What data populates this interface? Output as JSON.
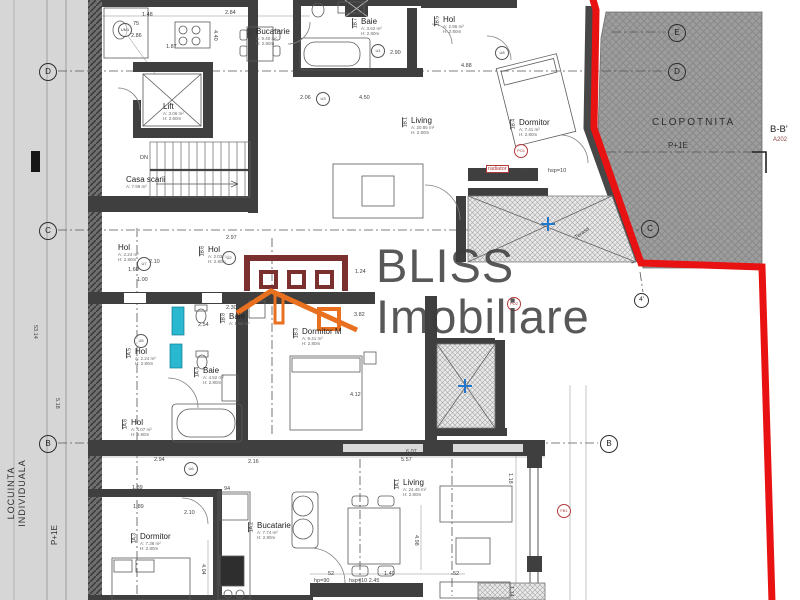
{
  "watermark": {
    "line1": "BLISS",
    "line2": "Imobiliare"
  },
  "logo_colors": {
    "building": "#7b3030",
    "roof": "#e8701f"
  },
  "accents": {
    "property_line": "#e81212",
    "fixture_teal": "#29b8cf",
    "drain_blue": "#2277cc"
  },
  "left_band": {
    "zone_line1": "LOCUINTA",
    "zone_line2": "INDIVIDUALA",
    "level": "P+1E"
  },
  "clopotnita": {
    "label": "CLOPOTNITA",
    "level": "P+1E"
  },
  "section_mark": {
    "label": "B-B'",
    "sheet": "A202"
  },
  "plan": {
    "rooms": [
      {
        "id": "1B.2",
        "name": "Bucatarie",
        "area": "A: 9.40 m²",
        "h": "H: 2.80m",
        "x": 247,
        "y": 28
      },
      {
        "id": "",
        "name": "Lift",
        "area": "A: 3.06 m²",
        "h": "H: 2.60m",
        "x": 163,
        "y": 103
      },
      {
        "id": "",
        "name": "Casa scarii",
        "area": "A: 7.99 m²",
        "h": "",
        "x": 126,
        "y": 176
      },
      {
        "id": "1B.7",
        "name": "Baie",
        "area": "A: 3.62 m²",
        "h": "H: 2.80m",
        "x": 352,
        "y": 18
      },
      {
        "id": "1B.5",
        "name": "Hol",
        "area": "A: 2.96 m²",
        "h": "H: 2.80m",
        "x": 434,
        "y": 16
      },
      {
        "id": "1B.1",
        "name": "Living",
        "area": "A: 20.85 m²",
        "h": "H: 2.80m",
        "x": 402,
        "y": 117
      },
      {
        "id": "1B.4",
        "name": "Dormitor",
        "area": "A: 7.41 m²",
        "h": "H: 2.80m",
        "x": 510,
        "y": 119
      },
      {
        "id": "1B.6",
        "name": "Hol",
        "area": "A: 2.03 m²",
        "h": "H: 2.80m",
        "x": 199,
        "y": 246
      },
      {
        "id": "",
        "name": "Hol",
        "area": "A: 2.24 m²",
        "h": "H: 2.80m",
        "x": 118,
        "y": 244
      },
      {
        "id": "1B.8",
        "name": "Baie",
        "area": "A: 1.92 m²",
        "h": "",
        "x": 220,
        "y": 313
      },
      {
        "id": "1B.3",
        "name": "Dormitor M",
        "area": "A: 9.41 m²",
        "h": "H: 2.80m",
        "x": 293,
        "y": 328
      },
      {
        "id": "1A.5",
        "name": "Hol",
        "area": "A: 2.24 m²",
        "h": "H: 2.80m",
        "x": 126,
        "y": 348
      },
      {
        "id": "1A.4",
        "name": "Baie",
        "area": "A: 4.52 m²",
        "h": "H: 2.80m",
        "x": 194,
        "y": 367
      },
      {
        "id": "1A.6",
        "name": "Hol",
        "area": "A: 4.07 m²",
        "h": "H: 2.80m",
        "x": 122,
        "y": 419
      },
      {
        "id": "1A.3",
        "name": "Dormitor",
        "area": "A: 7.38 m²",
        "h": "H: 2.80m",
        "x": 131,
        "y": 533
      },
      {
        "id": "1A.2",
        "name": "Bucatarie",
        "area": "A: 7.74 m²",
        "h": "H: 2.80m",
        "x": 248,
        "y": 522
      },
      {
        "id": "1A.1",
        "name": "Living",
        "area": "A: 24.45 m²",
        "h": "H: 2.80m",
        "x": 394,
        "y": 479
      }
    ],
    "grid_markers": [
      {
        "label": "D",
        "x": 47,
        "y": 71
      },
      {
        "label": "C",
        "x": 47,
        "y": 230
      },
      {
        "label": "B",
        "x": 47,
        "y": 443
      },
      {
        "label": "E",
        "x": 676,
        "y": 32
      },
      {
        "label": "D",
        "x": 676,
        "y": 71
      },
      {
        "label": "C",
        "x": 649,
        "y": 228
      },
      {
        "label": "B",
        "x": 608,
        "y": 443
      },
      {
        "label": "4'",
        "x": 642,
        "y": 301,
        "small": true
      }
    ],
    "circle_markers": [
      {
        "t": "UM1",
        "x": 124,
        "y": 29
      },
      {
        "t": "U1",
        "x": 377,
        "y": 50
      },
      {
        "t": "U8",
        "x": 501,
        "y": 52
      },
      {
        "t": "U3",
        "x": 322,
        "y": 98
      },
      {
        "t": "U2",
        "x": 228,
        "y": 257
      },
      {
        "t": "U7",
        "x": 143,
        "y": 263
      },
      {
        "t": "U5",
        "x": 140,
        "y": 340
      },
      {
        "t": "U6",
        "x": 190,
        "y": 468
      },
      {
        "t": "PO1",
        "x": 520,
        "y": 150,
        "red": true
      },
      {
        "t": "PO2",
        "x": 513,
        "y": 303,
        "red": true
      },
      {
        "t": "FB1",
        "x": 563,
        "y": 510,
        "red": true
      }
    ],
    "annotations": [
      {
        "t": "1.48",
        "x": 142,
        "y": 12
      },
      {
        "t": "2.84",
        "x": 225,
        "y": 10
      },
      {
        "t": "1.87",
        "x": 166,
        "y": 44
      },
      {
        "t": "4.40",
        "x": 218,
        "y": 30,
        "r": 90
      },
      {
        "t": "2.06",
        "x": 300,
        "y": 95
      },
      {
        "t": "75",
        "x": 133,
        "y": 21
      },
      {
        "t": "2.86",
        "x": 131,
        "y": 33
      },
      {
        "t": "2.90",
        "x": 390,
        "y": 50
      },
      {
        "t": "3.60",
        "x": 361,
        "y": 72
      },
      {
        "t": "4.50",
        "x": 359,
        "y": 95
      },
      {
        "t": "4.88",
        "x": 461,
        "y": 63
      },
      {
        "t": "DN",
        "x": 140,
        "y": 155
      },
      {
        "t": "+3.60",
        "x": 126,
        "y": 201
      },
      {
        "t": "2.97",
        "x": 226,
        "y": 235
      },
      {
        "t": "2.10",
        "x": 149,
        "y": 259
      },
      {
        "t": "1.60",
        "x": 128,
        "y": 267
      },
      {
        "t": "1.00",
        "x": 137,
        "y": 277
      },
      {
        "t": "2.30",
        "x": 226,
        "y": 305
      },
      {
        "t": "2.54",
        "x": 198,
        "y": 322
      },
      {
        "t": "1.24",
        "x": 355,
        "y": 269
      },
      {
        "t": "2.76",
        "x": 353,
        "y": 298
      },
      {
        "t": "3.82",
        "x": 354,
        "y": 312
      },
      {
        "t": "4.12",
        "x": 350,
        "y": 392
      },
      {
        "t": "radiator",
        "x": 486,
        "y": 165,
        "red": true
      },
      {
        "t": "hp=90",
        "x": 514,
        "y": 168
      },
      {
        "t": "hsp=10",
        "x": 548,
        "y": 168
      },
      {
        "t": "Terasa",
        "x": 574,
        "y": 236,
        "r": -37
      },
      {
        "t": "1.59",
        "x": 127,
        "y": 449
      },
      {
        "t": "2.94",
        "x": 154,
        "y": 457
      },
      {
        "t": "1.89",
        "x": 132,
        "y": 485
      },
      {
        "t": "1.89",
        "x": 133,
        "y": 504
      },
      {
        "t": "2.10",
        "x": 184,
        "y": 510
      },
      {
        "t": "94",
        "x": 224,
        "y": 486
      },
      {
        "t": "6.07",
        "x": 406,
        "y": 449
      },
      {
        "t": "5.57",
        "x": 401,
        "y": 457
      },
      {
        "t": "2.16",
        "x": 248,
        "y": 459
      },
      {
        "t": "1.40",
        "x": 384,
        "y": 571
      },
      {
        "t": "52",
        "x": 328,
        "y": 571
      },
      {
        "t": "52",
        "x": 453,
        "y": 571
      },
      {
        "t": "hp=90",
        "x": 314,
        "y": 578
      },
      {
        "t": "hsp=10 2.45",
        "x": 349,
        "y": 578
      },
      {
        "t": "4.04",
        "x": 206,
        "y": 564,
        "r": 90
      },
      {
        "t": "4.98",
        "x": 419,
        "y": 535,
        "r": 90
      },
      {
        "t": "1.18",
        "x": 513,
        "y": 473,
        "r": 90
      },
      {
        "t": "1.14",
        "x": 514,
        "y": 586,
        "r": 90
      },
      {
        "t": "53.14",
        "x": 38,
        "y": 325,
        "r": 90
      },
      {
        "t": "5.18",
        "x": 60,
        "y": 398,
        "r": 90
      }
    ]
  }
}
